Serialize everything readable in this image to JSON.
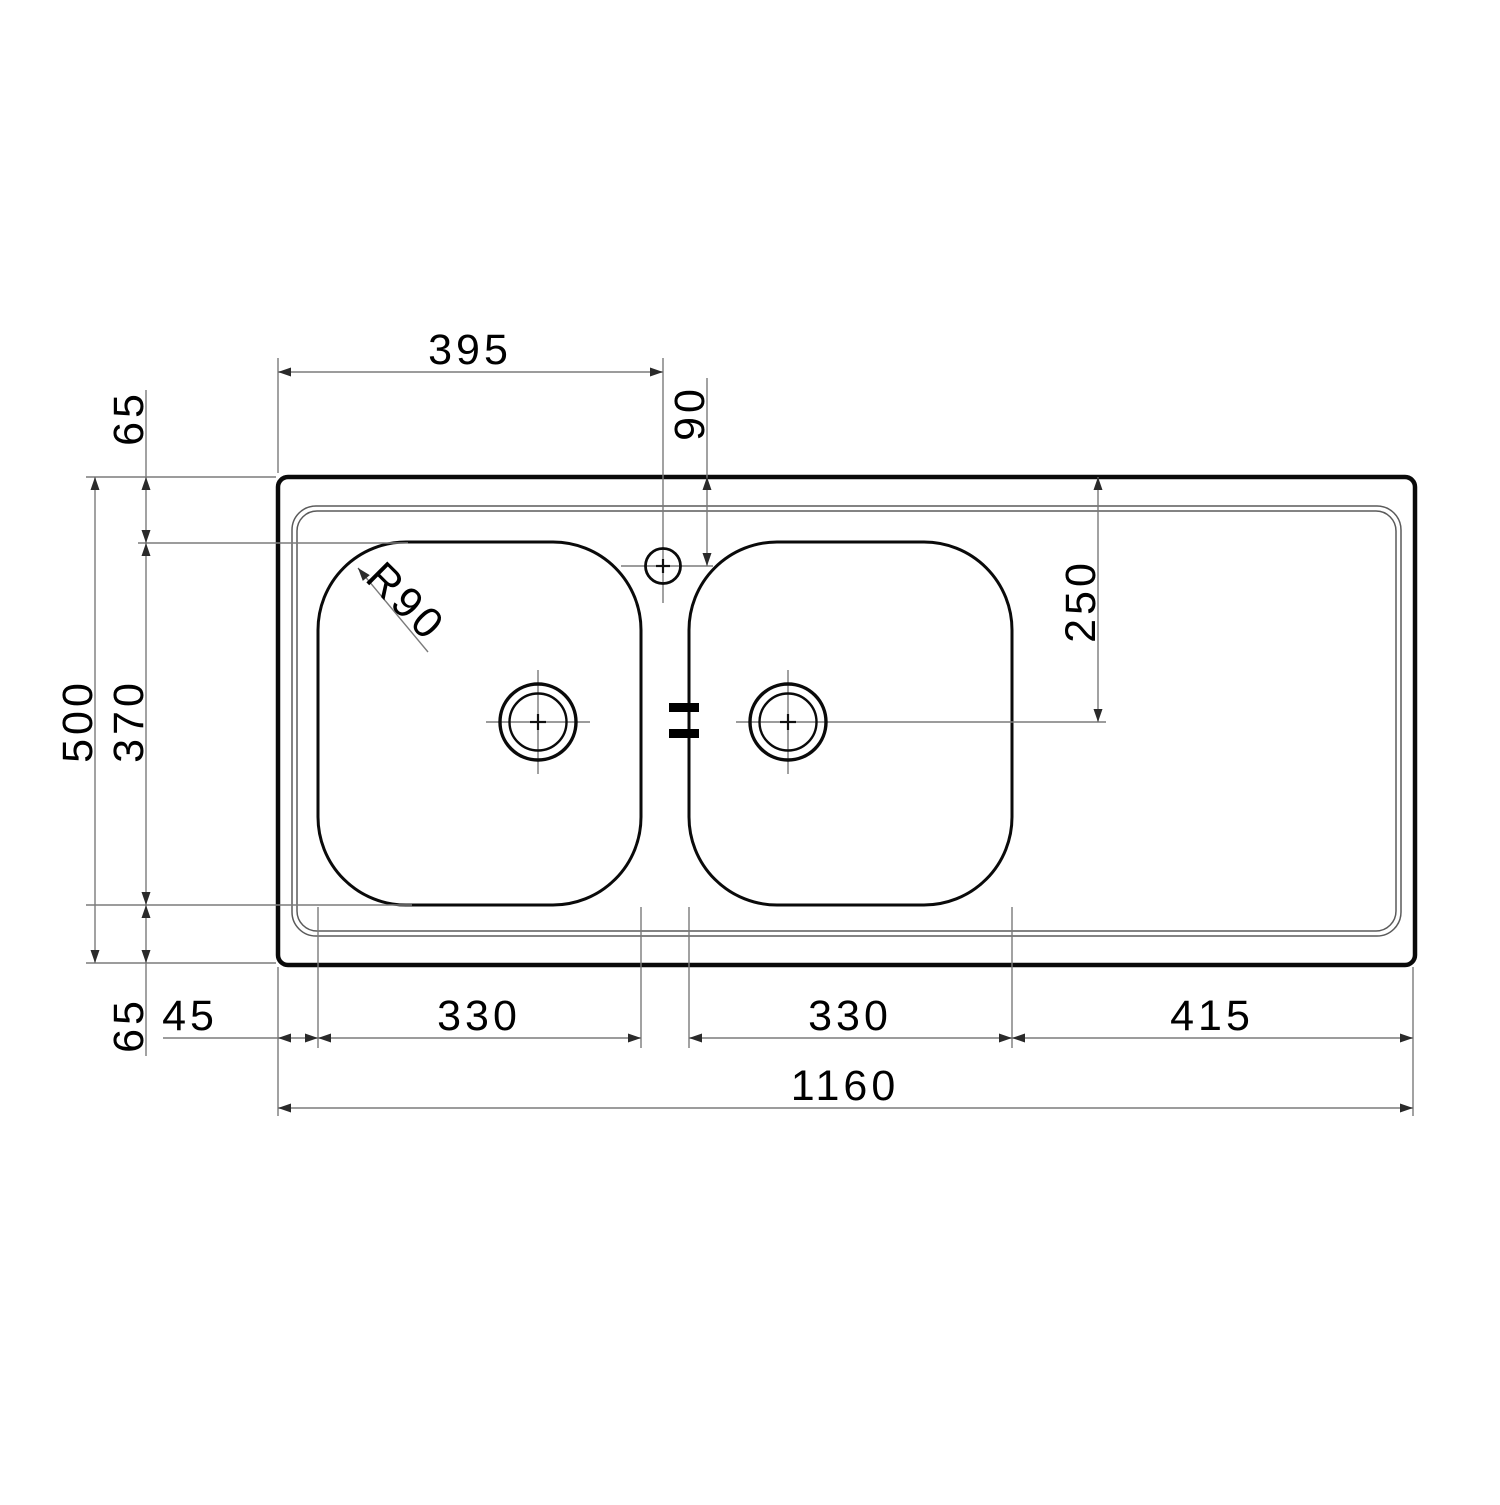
{
  "drawing": {
    "ink_color": "#000000",
    "line_color": "#7b7b7b",
    "dims": {
      "top_width": "395",
      "faucet_offset": "90",
      "rim_top": "65",
      "overall_depth": "500",
      "bowl_depth": "370",
      "rim_bottom": "65",
      "left_rim": "45",
      "bowl_left_width": "330",
      "bowl_right_width": "330",
      "drainer_width": "415",
      "overall_width": "1160",
      "drain_offset": "250",
      "bowl_corner_radius": "R90"
    }
  }
}
